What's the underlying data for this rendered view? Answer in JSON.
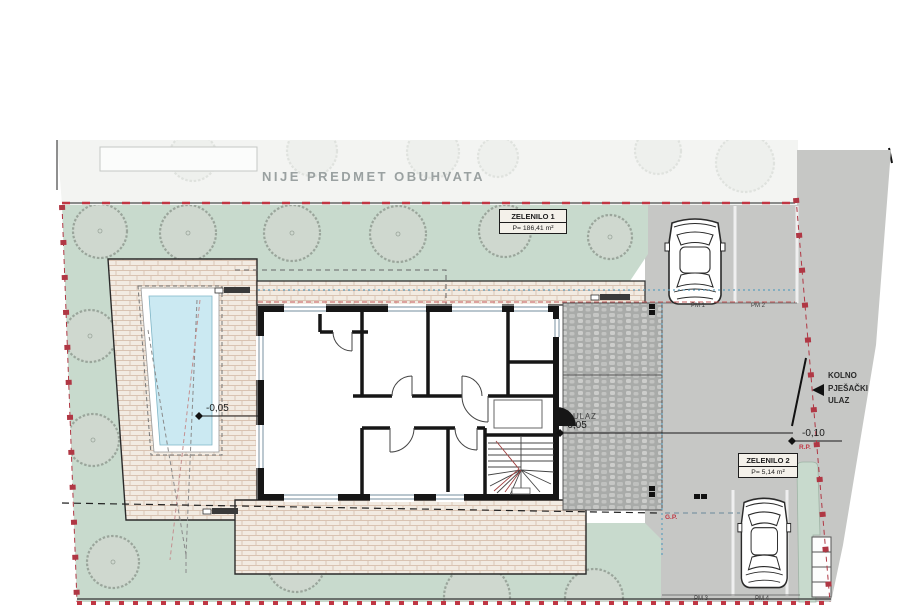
{
  "plan": {
    "note_top": "NIJE PREDMET OBUHVATA",
    "zelenilo1_title": "ZELENILO 1",
    "zelenilo1_area": "P= 186,41 m²",
    "zelenilo2_title": "ZELENILO 2",
    "zelenilo2_area": "P= 5,14 m²",
    "kolno_line1": "KOLNO",
    "kolno_line2": "PJEŠAČKI",
    "kolno_line3": "ULAZ",
    "entrance_label": "ULAZ",
    "level_entrance": "-0,05",
    "level_terrace": "-0,05",
    "level_street": "-0,10",
    "marker_rp": "R.P.",
    "marker_gp": "G.P.",
    "parking": {
      "pm1": "PM 1",
      "pm2": "PM 2",
      "pm3": "PM 3",
      "pm4": "PM 4"
    }
  },
  "colors": {
    "greenery": "#c8dacd",
    "street_gray": "#c6c7c5",
    "boundary_red": "#b63a44",
    "pool_water": "#cbe9f2",
    "brick_paving": "#f2ebe2",
    "cobble_paving": "#adaeac",
    "wall_black": "#161616",
    "guide_blue": "#5e9fbe",
    "note_gray": "#9aa1a1"
  }
}
